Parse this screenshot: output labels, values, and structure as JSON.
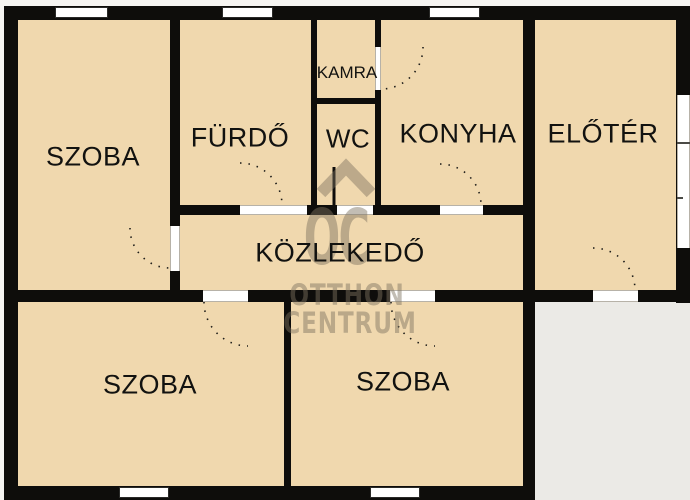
{
  "floorplan": {
    "rooms": [
      {
        "name": "szoba-top-left",
        "label": "SZOBA"
      },
      {
        "name": "furdo",
        "label": "FÜRDŐ"
      },
      {
        "name": "kamra",
        "label": "KAMRA"
      },
      {
        "name": "wc",
        "label": "WC"
      },
      {
        "name": "konyha",
        "label": "KONYHA"
      },
      {
        "name": "eloter",
        "label": "ELŐTÉR"
      },
      {
        "name": "kozlekedo",
        "label": "KÖZLEKEDŐ"
      },
      {
        "name": "szoba-bottom-left",
        "label": "SZOBA"
      },
      {
        "name": "szoba-bottom-middle",
        "label": "SZOBA"
      }
    ],
    "watermark": {
      "logo": "OC",
      "line1": "OTTHON",
      "line2": "CENTRUM"
    },
    "colors": {
      "floor": "#f0d8ae",
      "wall": "#0e0d0b",
      "outside_area": "#ebeae6",
      "opening_white": "#ffffff",
      "watermark_grey": "#7d7260"
    }
  }
}
